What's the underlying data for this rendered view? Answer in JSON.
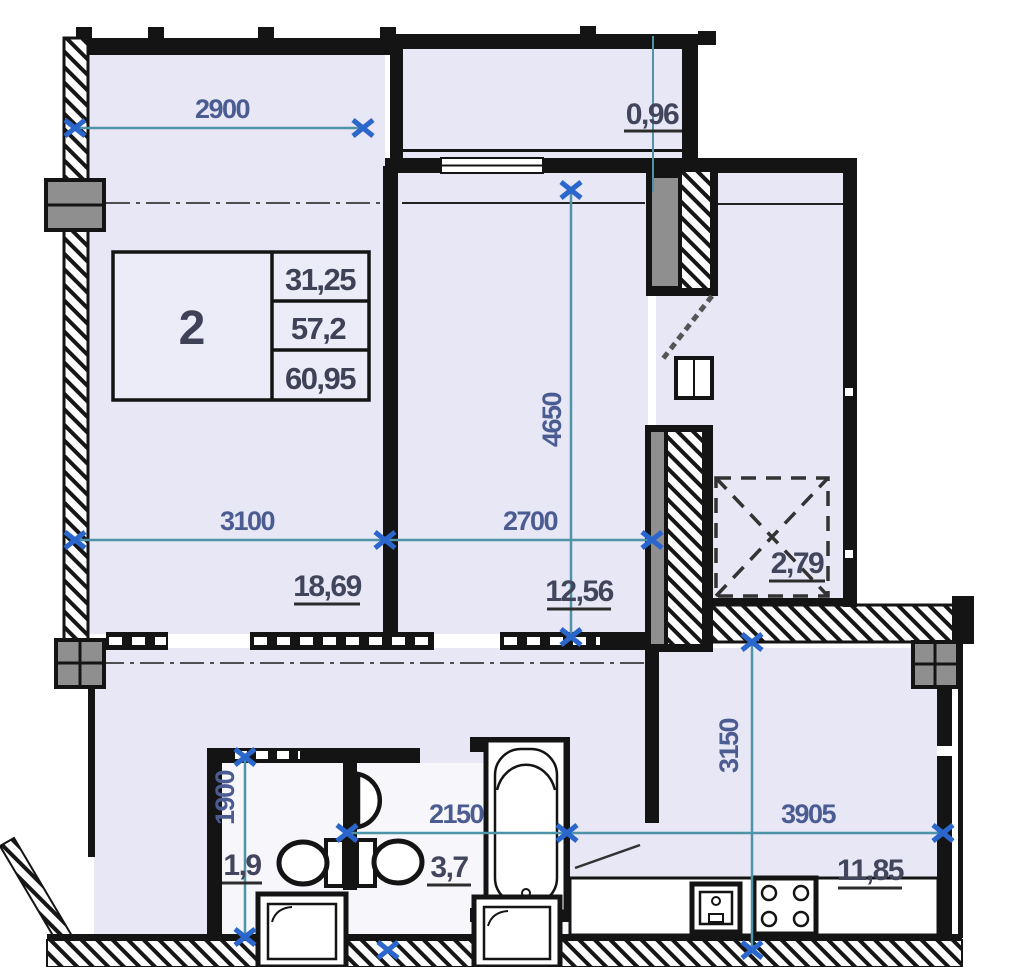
{
  "stamp": {
    "rooms_count": "2",
    "living_area": "31,25",
    "apartment_area": "57,2",
    "total_area": "60,95"
  },
  "dimensions": {
    "bedroom_window_width": "2900",
    "bedroom_width": "3100",
    "living_width": "2700",
    "living_depth": "4650",
    "wc_depth": "1900",
    "bath_width": "2150",
    "kitchen_width": "3905",
    "kitchen_depth": "3150"
  },
  "areas": {
    "balcony": "0,96",
    "bedroom": "18,69",
    "living": "12,56",
    "wardrobe": "2,79",
    "wc": "1,9",
    "bathroom": "3,7",
    "kitchen": "11,85"
  },
  "colors": {
    "room_fill": "#e7e7f5",
    "wet_room_fill": "#f7f7fb",
    "wall": "#141414",
    "column_gray": "#8f8f8f",
    "dimension_line": "#4f93a8",
    "dimension_marker": "#2b66cc",
    "dimension_text": "#4b5c92",
    "area_text": "#41465c"
  }
}
